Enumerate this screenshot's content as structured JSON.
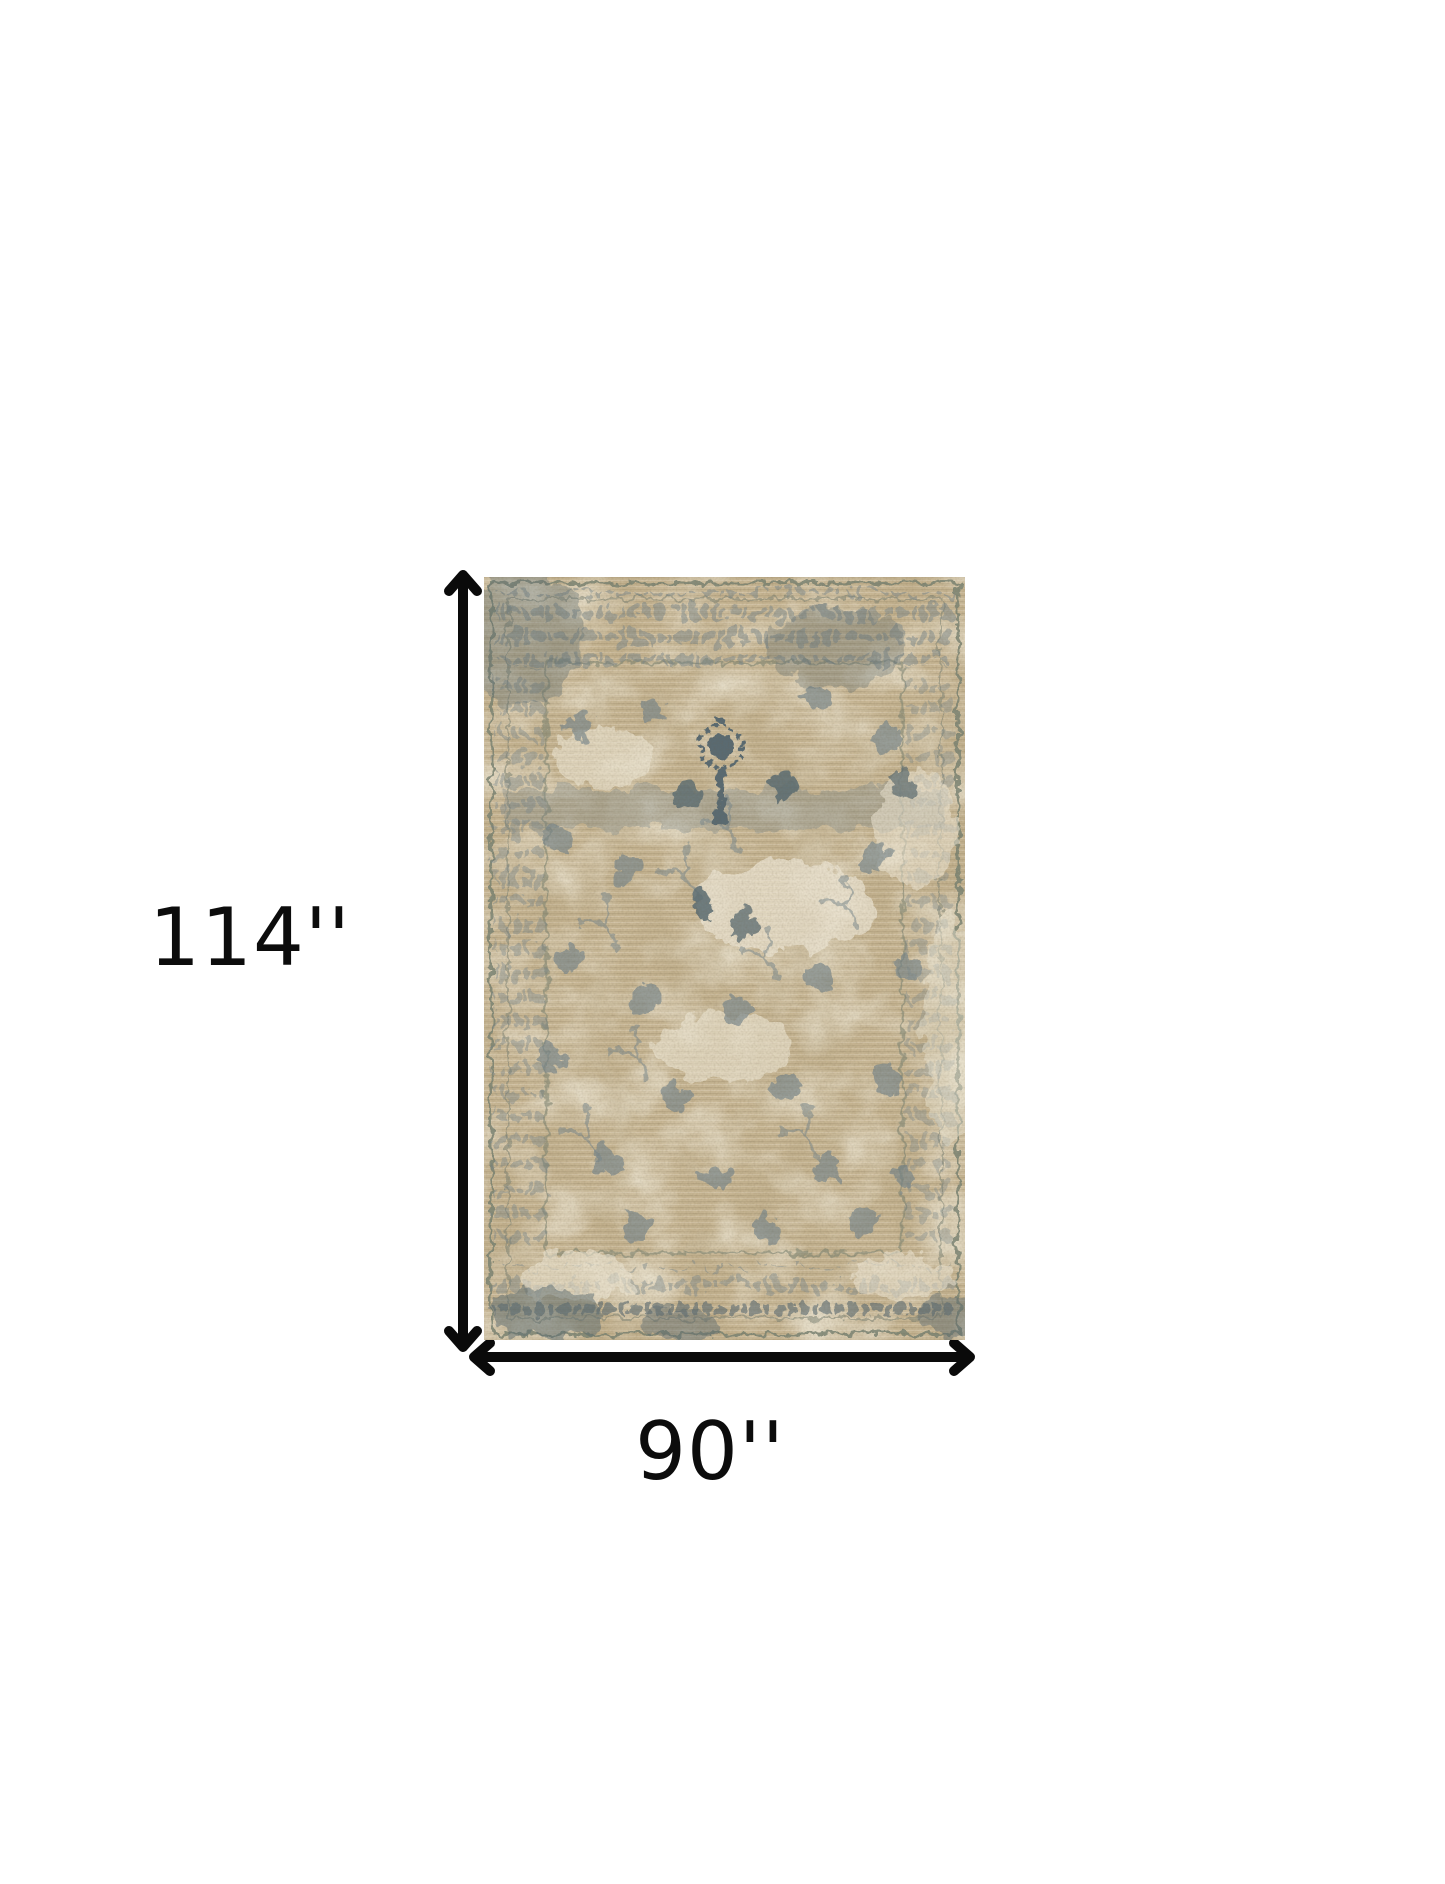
{
  "diagram": {
    "type": "product-dimensions",
    "product_description": "Distressed vintage oriental area rug, beige with grey-blue floral pattern",
    "height_label": "114''",
    "width_label": "90''",
    "background": "#ffffff",
    "arrow_color": "#0a0a0a",
    "label_color": "#0c0c0c",
    "rug_colors": {
      "base": "#c8b795",
      "base_shadow": "#b5a37e",
      "cream": "#ebe4d1",
      "motif": "#74848a",
      "motif_dark": "#5a6b71",
      "border_line": "#77806f"
    }
  }
}
